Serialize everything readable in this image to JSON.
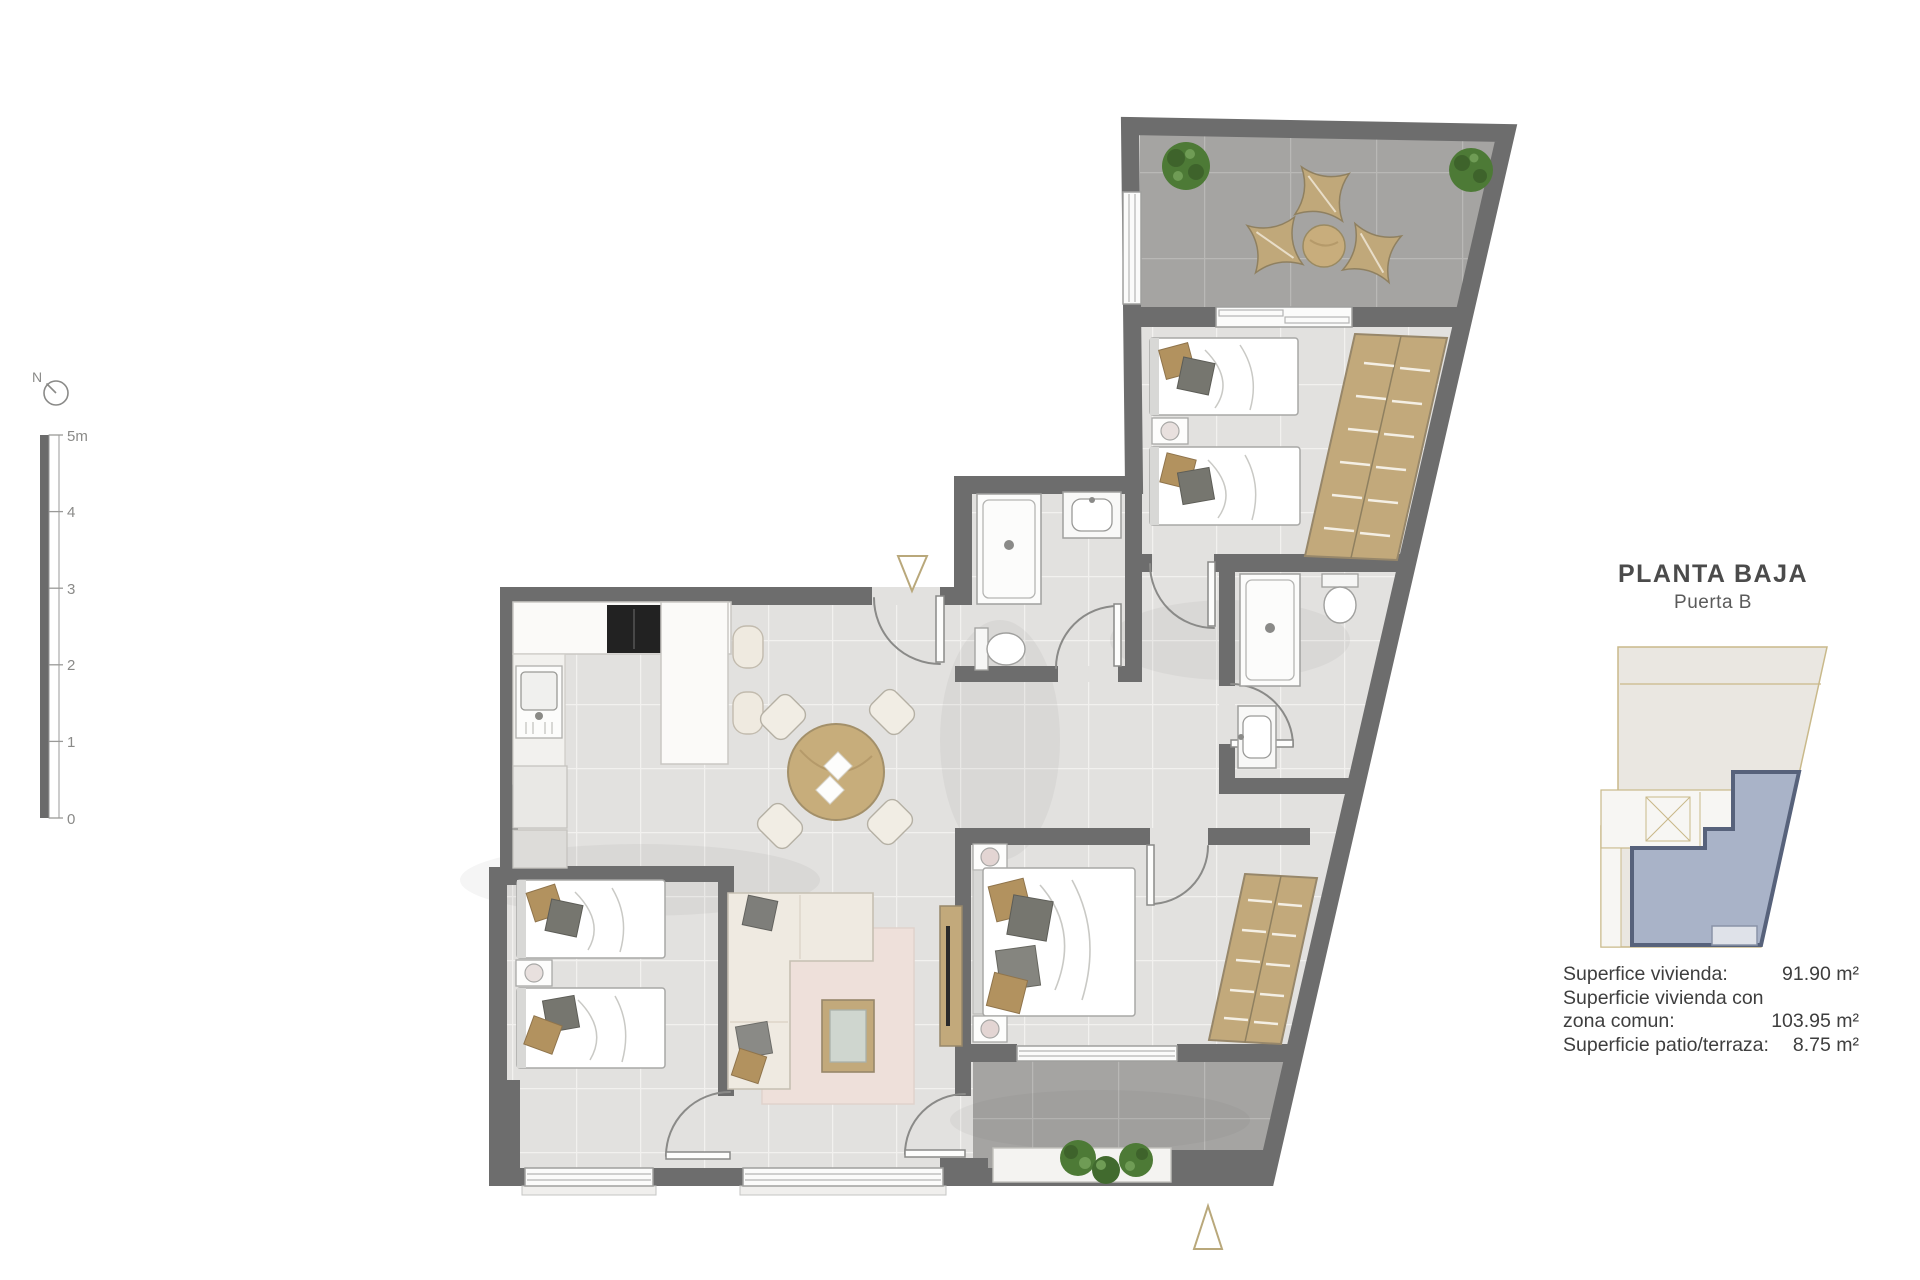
{
  "panel": {
    "title": "PLANTA BAJA",
    "subtitle": "Puerta B",
    "area_rows": [
      {
        "label": "Superfice vivienda:",
        "value": "91.90 m²"
      },
      {
        "label": "Superficie vivienda con",
        "value": ""
      },
      {
        "label": "zona comun:",
        "value": "103.95 m²"
      },
      {
        "label": "Superficie patio/terraza:",
        "value": "8.75 m²"
      }
    ]
  },
  "compass": {
    "label": "N"
  },
  "scale_bar": {
    "ticks": [
      "5m",
      "4",
      "3",
      "2",
      "1",
      "0"
    ]
  },
  "colors": {
    "wall": "#6d6d6d",
    "floor_tile": "#e2e1df",
    "floor_grout": "#f2f1ef",
    "terrace_tile": "#a5a4a2",
    "terrace_grout": "#b9b8b6",
    "wood": "#c7ad7b",
    "cream": "#efeae1",
    "plant_green": "#4d7a36",
    "accent_tan": "#b9a87b",
    "keyplan_unit_fill": "#a9b3c8",
    "keyplan_unit_stroke": "#57627b",
    "keyplan_outline": "#c9b98a",
    "text": "#3e3e3e"
  }
}
